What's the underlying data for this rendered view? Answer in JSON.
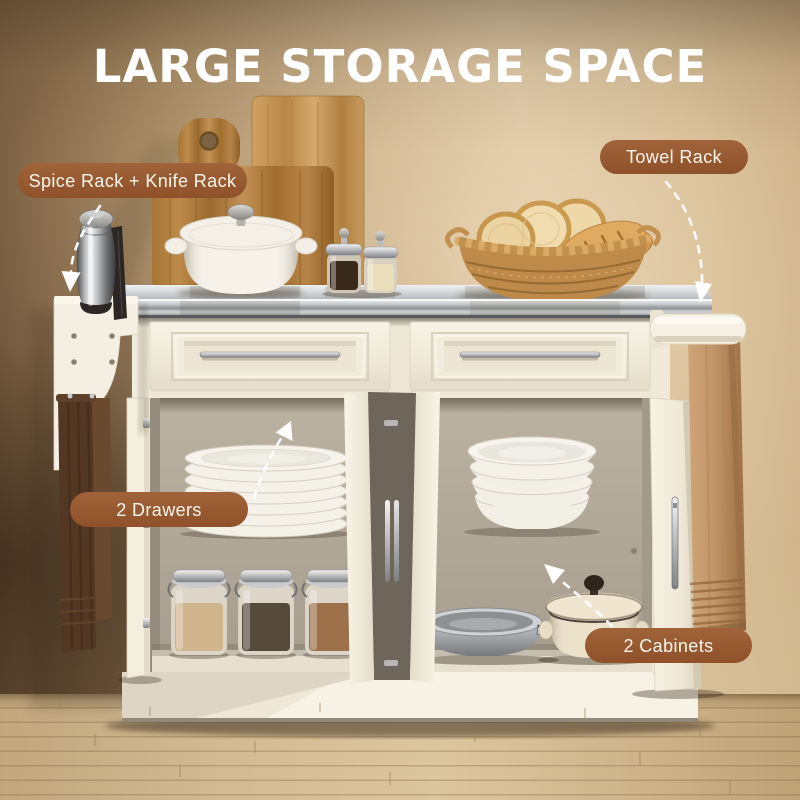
{
  "headline": "LARGE STORAGE SPACE",
  "callouts": {
    "spice_knife_rack": {
      "label": "Spice Rack + Knife Rack"
    },
    "towel_rack": {
      "label": "Towel Rack"
    },
    "drawers": {
      "label": "2 Drawers"
    },
    "cabinets": {
      "label": "2 Cabinets"
    }
  },
  "colors": {
    "callout_background": "#96572d",
    "callout_text": "#fdf6ec",
    "headline_text": "#ffffff",
    "arrow": "#ffffff",
    "wall_dark_brown": "#6a5139",
    "wall_light_tan": "#d9c3a1",
    "cart_cream": "#f3edde",
    "countertop_steel": "#c7cacc",
    "floor_wood": "#cab189"
  }
}
